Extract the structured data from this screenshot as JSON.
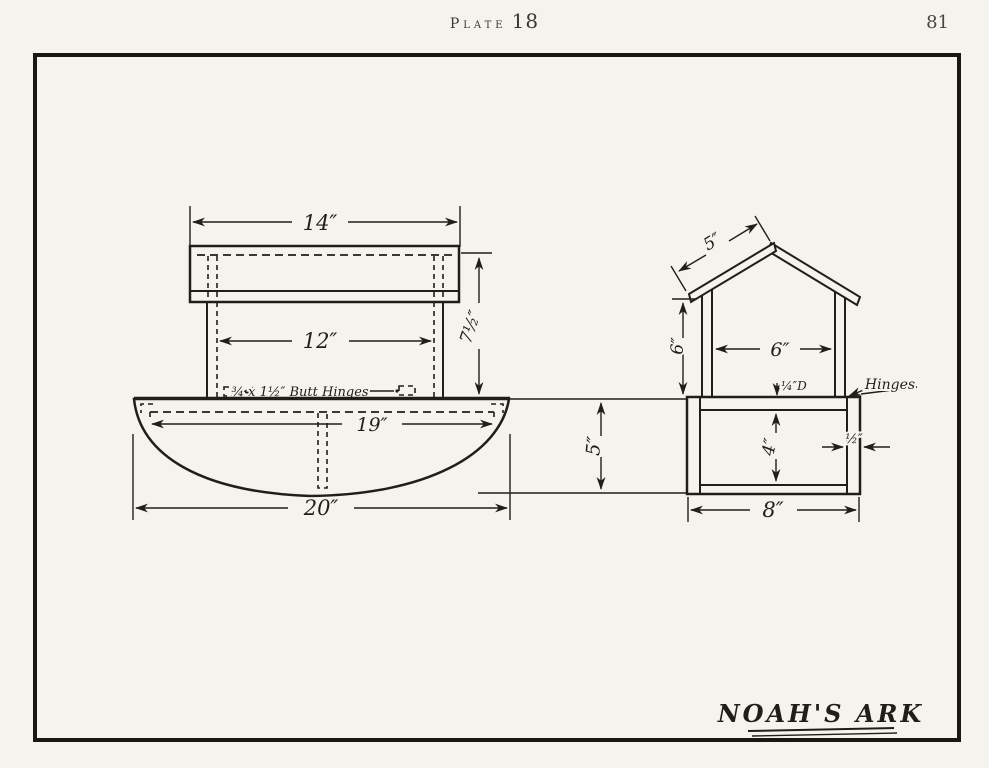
{
  "page": {
    "plate_label": "Plate",
    "plate_number": "18",
    "page_number": "81",
    "title": "NOAH'S ARK",
    "ink_color": "#211e1a",
    "paper_color": "#f4f3ee"
  },
  "side_view": {
    "dims": {
      "roof_width": "14″",
      "cabin_width": "12″",
      "cabin_height": "7½″",
      "deck_length": "19″",
      "hull_length": "20″",
      "hull_height": "5″"
    },
    "hinge_note": "¾ x 1½″ Butt Hinges"
  },
  "end_view": {
    "dims": {
      "roof_slope": "5″",
      "wall_height": "6″",
      "opening_width": "6″",
      "inside_depth": "4″",
      "side_thickness": "½″",
      "hull_width": "8″",
      "deck_note": "¼″D"
    },
    "hinges_label": "Hinges"
  }
}
